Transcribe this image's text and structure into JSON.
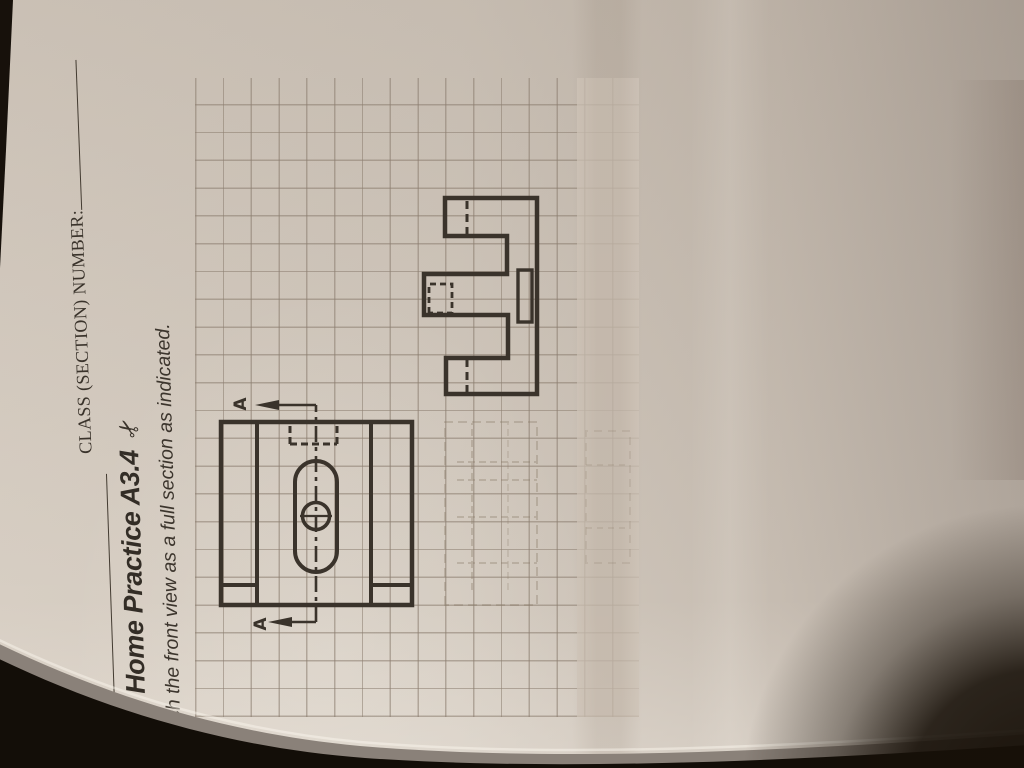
{
  "page": {
    "header": {
      "name_label": "NAME:",
      "class_label": "CLASS (SECTION) NUMBER:"
    },
    "title": {
      "text": "Take Home Practice A3.4",
      "scissors_char": "✂"
    },
    "instruction": {
      "text": "Sketch the front view as a full section as indicated."
    },
    "section": {
      "label_left": "A",
      "label_right": "A"
    }
  },
  "colors": {
    "paper": "#d2c9be",
    "grid_line": "#8b7d6f",
    "ink": "#3a332b",
    "pencil": "#8a7c69",
    "photo_background": "#140f09",
    "blanket_teal": "#3f8c85",
    "blanket_red": "#b2584c"
  }
}
